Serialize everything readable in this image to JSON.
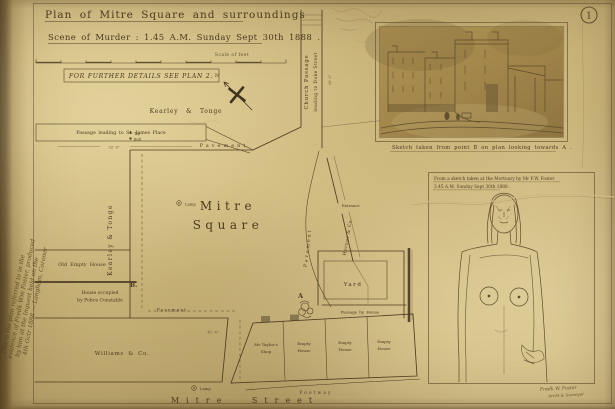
{
  "plate_number": "1",
  "header": {
    "title": "Plan of Mitre Square and surroundings",
    "subtitle": "Scene of Murder : 1.45 A.M. Sunday Sept 30th 1888 .",
    "scale_label": "Scale of feet",
    "details_note": "FOR FURTHER DETAILS SEE PLAN 2."
  },
  "map": {
    "labels": {
      "passage_st_james": "Passage leading to St. James Place",
      "passage_dim": "32' 6\"",
      "tap": "Tap",
      "bolt": "Bolt",
      "kearley_tonge": "Kearley & Tonge",
      "church_passage": "Church Passage",
      "church_passage_2": "leading to Duke Street",
      "church_passage_dim": "36' 6\"",
      "pavement": "Pavement",
      "mitre_square_1": "Mitre",
      "mitre_square_2": "Square",
      "old_empty_house": "Old Empty House",
      "police_house_1": "House occupied",
      "police_house_2": "by Police Constable",
      "williams": "Williams & Co.",
      "taylor_shop_1": "Mr Taylor's",
      "taylor_shop_2": "Shop",
      "empty_house_1": "Empty",
      "empty_house_2": "House",
      "footway": "Footway",
      "mitre_street": "Mitre Street",
      "yard": "Yard",
      "passage_by_house": "Passage by House",
      "entrance": "Entrance",
      "horner": "Horner & Co.",
      "lamp": "Lamp",
      "shops_dim": "41' 6\"",
      "point_a": "A",
      "point_b": "B.",
      "north": "N"
    }
  },
  "insets": {
    "street_sketch_caption": "Sketch taken from point B on plan looking towards A .",
    "mortuary_caption_1": "From a sketch taken at the Mortuary by Mr F.W. Foster",
    "mortuary_caption_2": "3.45 A.M. Sunday Sept 30th 1888 ."
  },
  "annotations": {
    "margin_note_1": "This is the plan referred to in the",
    "margin_note_2": "evidence of Fredk Wm Foster, produced",
    "margin_note_3": "by him at the Inquest held on the",
    "margin_note_4": "4th Octr 1888 — Langham, Coroner",
    "signature_1": "Fredk W. Foster",
    "signature_2": "Archt & Surveyor"
  }
}
